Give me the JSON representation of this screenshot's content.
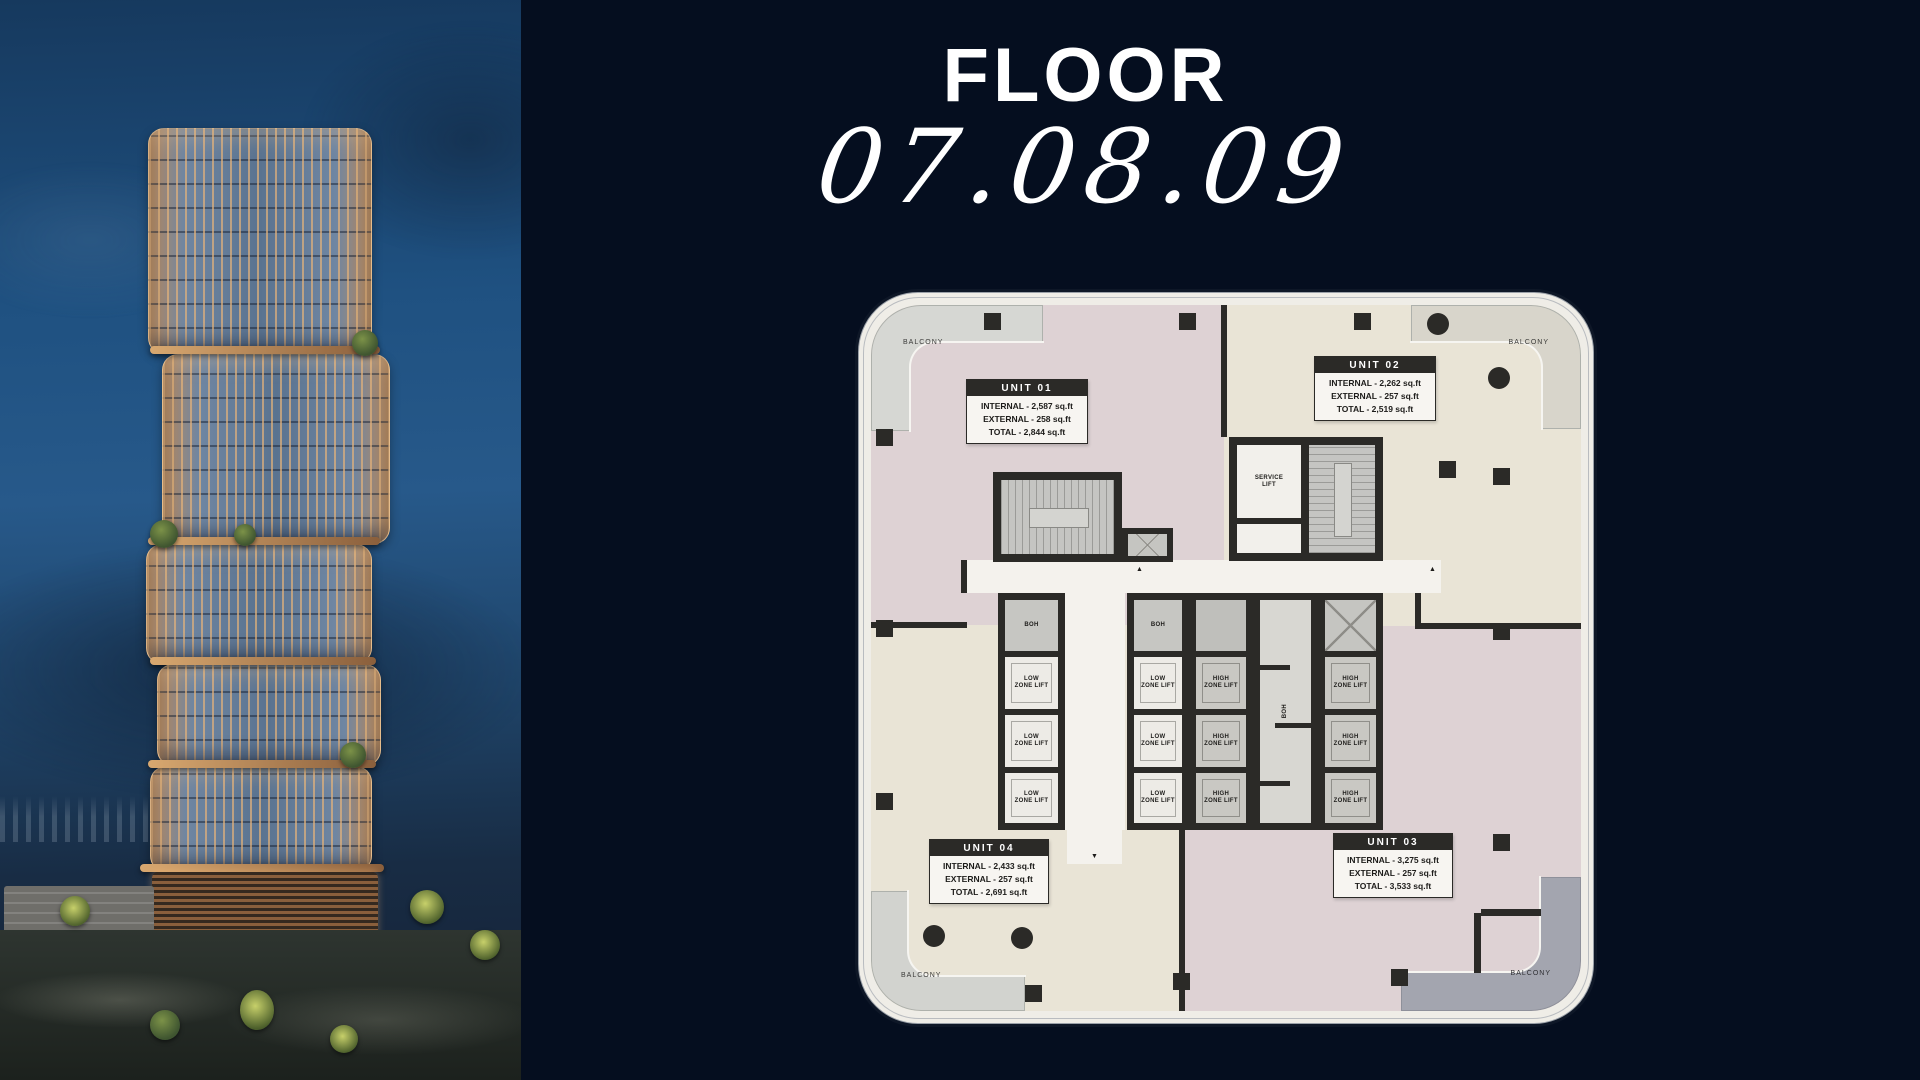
{
  "page": {
    "background": "#050e1f"
  },
  "header": {
    "title": "FLOOR",
    "floors": "07.08.09"
  },
  "photo": {
    "description": "tower-dusk-render"
  },
  "floorplan": {
    "balcony_label": "BALCONY",
    "rooms": {
      "service_lift": "SERVICE LIFT",
      "low_zone_lift": "LOW ZONE LIFT",
      "high_zone_lift": "HIGH ZONE LIFT",
      "boh": "BOH"
    },
    "units": [
      {
        "name": "UNIT 01",
        "internal": "INTERNAL - 2,587 sq.ft",
        "external": "EXTERNAL - 258 sq.ft",
        "total": "TOTAL - 2,844 sq.ft"
      },
      {
        "name": "UNIT 02",
        "internal": "INTERNAL - 2,262 sq.ft",
        "external": "EXTERNAL - 257 sq.ft",
        "total": "TOTAL - 2,519 sq.ft"
      },
      {
        "name": "UNIT 03",
        "internal": "INTERNAL - 3,275 sq.ft",
        "external": "EXTERNAL - 257 sq.ft",
        "total": "TOTAL - 3,533 sq.ft"
      },
      {
        "name": "UNIT 04",
        "internal": "INTERNAL - 2,433 sq.ft",
        "external": "EXTERNAL - 257 sq.ft",
        "total": "TOTAL - 2,691 sq.ft"
      }
    ],
    "colors": {
      "background": "#050e1f",
      "unit_pink": "#ded2d4",
      "unit_cream": "#e9e4d6",
      "core_wall": "#2b2a27",
      "balcony_gray": "#a3a5af"
    }
  }
}
